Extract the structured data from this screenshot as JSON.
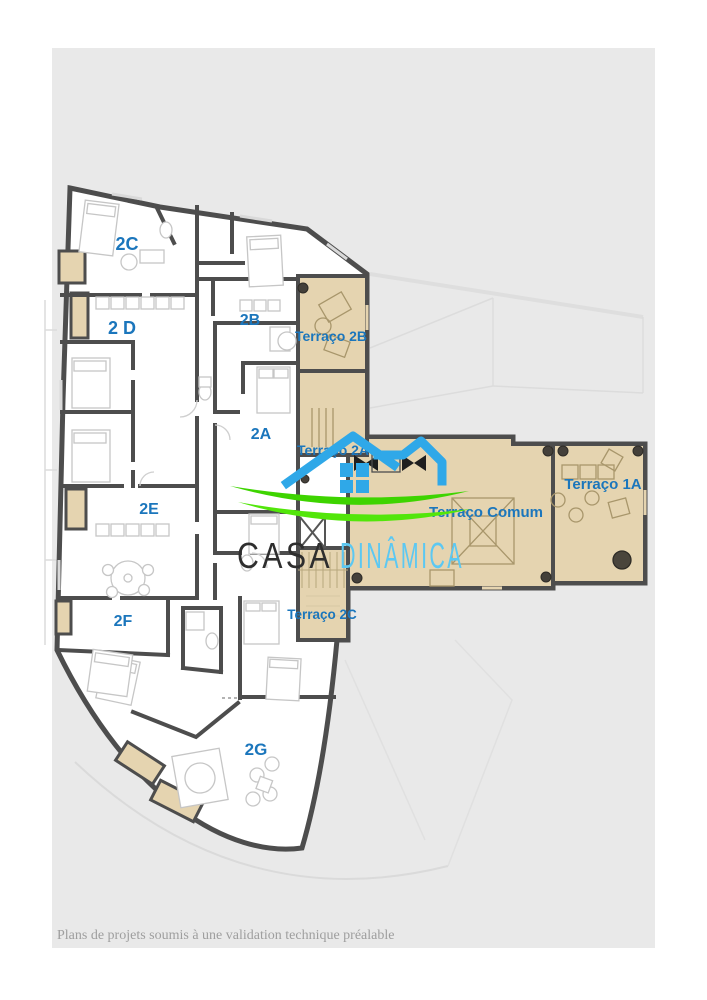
{
  "page": {
    "footer_note": "Plans de projets soumis à une validation technique préalable"
  },
  "floor_plan": {
    "labels": [
      {
        "id": "unit-2c",
        "text": "2C"
      },
      {
        "id": "unit-2d",
        "text": "2 D"
      },
      {
        "id": "unit-2b",
        "text": "2B"
      },
      {
        "id": "terraco-2b",
        "text": "Terraço 2B"
      },
      {
        "id": "unit-2a",
        "text": "2A"
      },
      {
        "id": "terraco-2a",
        "text": "Terraço 2A"
      },
      {
        "id": "unit-2e",
        "text": "2E"
      },
      {
        "id": "terraco-comum",
        "text": "Terraço Comum"
      },
      {
        "id": "terraco-1a",
        "text": "Terraço 1A"
      },
      {
        "id": "unit-2f",
        "text": "2F"
      },
      {
        "id": "terraco-2c",
        "text": "Terraço 2C"
      },
      {
        "id": "unit-2g",
        "text": "2G"
      }
    ],
    "colors": {
      "walls": "#4d4d4d",
      "room_fill": "#ffffff",
      "terrace_fill": "#e5d4b0",
      "label_blue": "#1b76bc",
      "sheet_gray": "#e9e9e9"
    }
  },
  "watermark": {
    "brand_word_1": "CASA",
    "brand_word_2": "DINÂMICA",
    "house_blue": "#2fa8e8",
    "swoosh_green": "#43d600",
    "word1_color": "#2e2e2e",
    "word2_color": "#5cc8f2"
  }
}
